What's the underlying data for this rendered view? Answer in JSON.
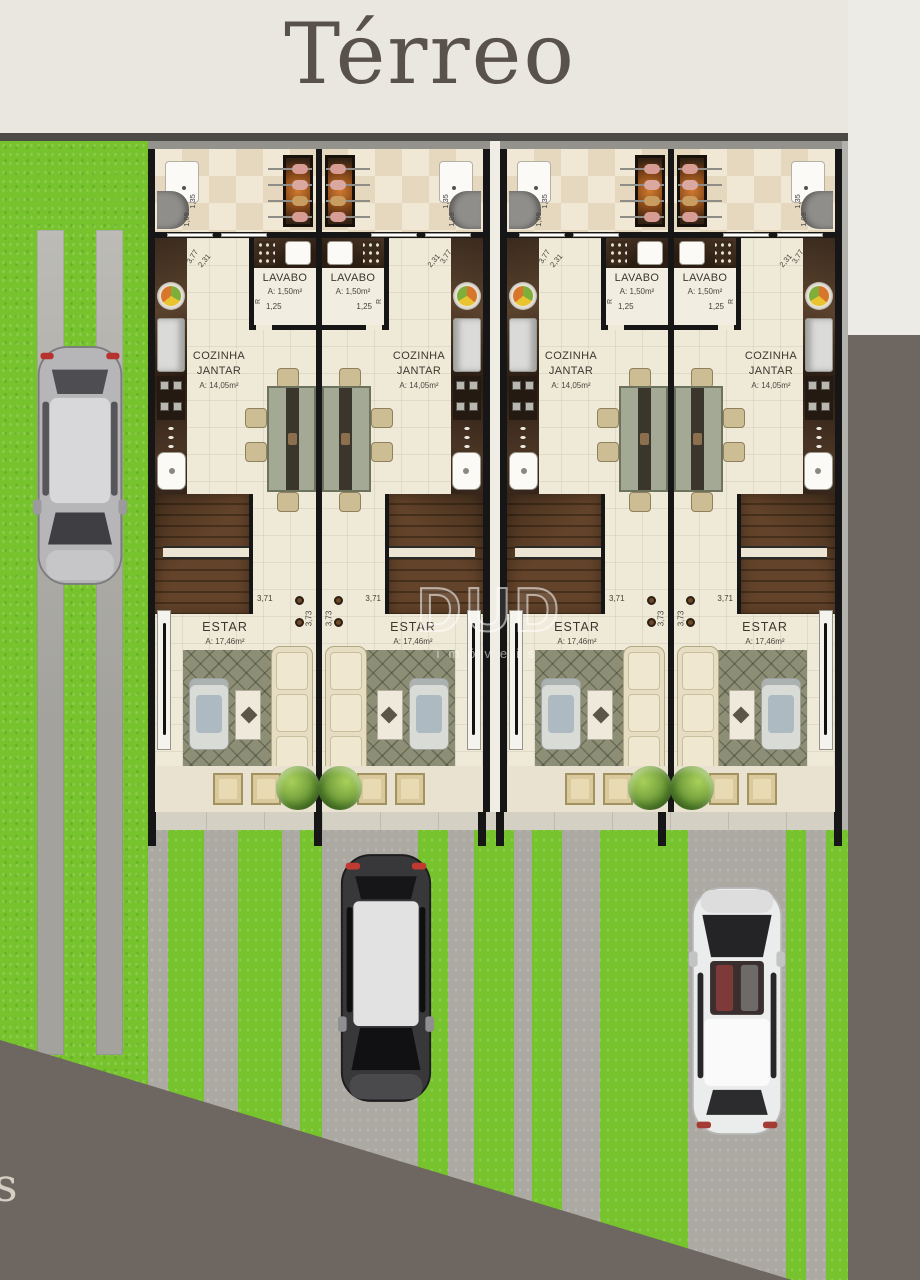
{
  "page": {
    "title": "Térreo",
    "corner_letter": "s"
  },
  "watermark": {
    "brand": "DUD",
    "sub": "imóveis"
  },
  "colors": {
    "header_bg": "#eae7e1",
    "grass": "#76c32d",
    "concrete": "#aba9a2",
    "wall": "#161616",
    "floor_cream": "#efe9d8",
    "backdrop_dark": "#6e6660",
    "stairs_wood": "#5a3c20",
    "counter_brown": "#3a2a1e"
  },
  "cars": [
    {
      "name": "silver-car",
      "body": "silver"
    },
    {
      "name": "black-car-silver-roof",
      "body": "black"
    },
    {
      "name": "white-car",
      "body": "white"
    }
  ],
  "units": [
    {
      "name": "Unidade 1",
      "lavabo": {
        "label": "LAVABO",
        "area": "A: 1,50m²",
        "width": "1,25",
        "door_letter": "R"
      },
      "terraco": {
        "dim_a": "1,35",
        "dim_b": "1,09"
      },
      "cozinha": {
        "line1": "COZINHA",
        "line2": "JANTAR",
        "area": "A: 14,05m²",
        "dim_a": "3,77",
        "dim_b": "2,31"
      },
      "estar": {
        "label": "ESTAR",
        "area": "A: 17,46m²",
        "dim_a": "3,71",
        "dim_b": "3,73"
      }
    },
    {
      "name": "Unidade 2",
      "lavabo": {
        "label": "LAVABO",
        "area": "A: 1,50m²",
        "width": "1,25",
        "door_letter": "R"
      },
      "terraco": {
        "dim_a": "1,35",
        "dim_b": "1,09"
      },
      "cozinha": {
        "line1": "COZINHA",
        "line2": "JANTAR",
        "area": "A: 14,05m²",
        "dim_a": "3,77",
        "dim_b": "2,31"
      },
      "estar": {
        "label": "ESTAR",
        "area": "A: 17,46m²",
        "dim_a": "3,71",
        "dim_b": "3,73"
      }
    },
    {
      "name": "Unidade 3",
      "lavabo": {
        "label": "LAVABO",
        "area": "A: 1,50m²",
        "width": "1,25",
        "door_letter": "R"
      },
      "terraco": {
        "dim_a": "1,35",
        "dim_b": "1,09"
      },
      "cozinha": {
        "line1": "COZINHA",
        "line2": "JANTAR",
        "area": "A: 14,05m²",
        "dim_a": "3,77",
        "dim_b": "2,31"
      },
      "estar": {
        "label": "ESTAR",
        "area": "A: 17,46m²",
        "dim_a": "3,71",
        "dim_b": "3,73"
      }
    },
    {
      "name": "Unidade 4",
      "lavabo": {
        "label": "LAVABO",
        "area": "A: 1,50m²",
        "width": "1,25",
        "door_letter": "R"
      },
      "terraco": {
        "dim_a": "1,35",
        "dim_b": "1,09"
      },
      "cozinha": {
        "line1": "COZINHA",
        "line2": "JANTAR",
        "area": "A: 14,05m²",
        "dim_a": "3,77",
        "dim_b": "2,31"
      },
      "estar": {
        "label": "ESTAR",
        "area": "A: 17,46m²",
        "dim_a": "3,71",
        "dim_b": "3,73"
      }
    }
  ]
}
